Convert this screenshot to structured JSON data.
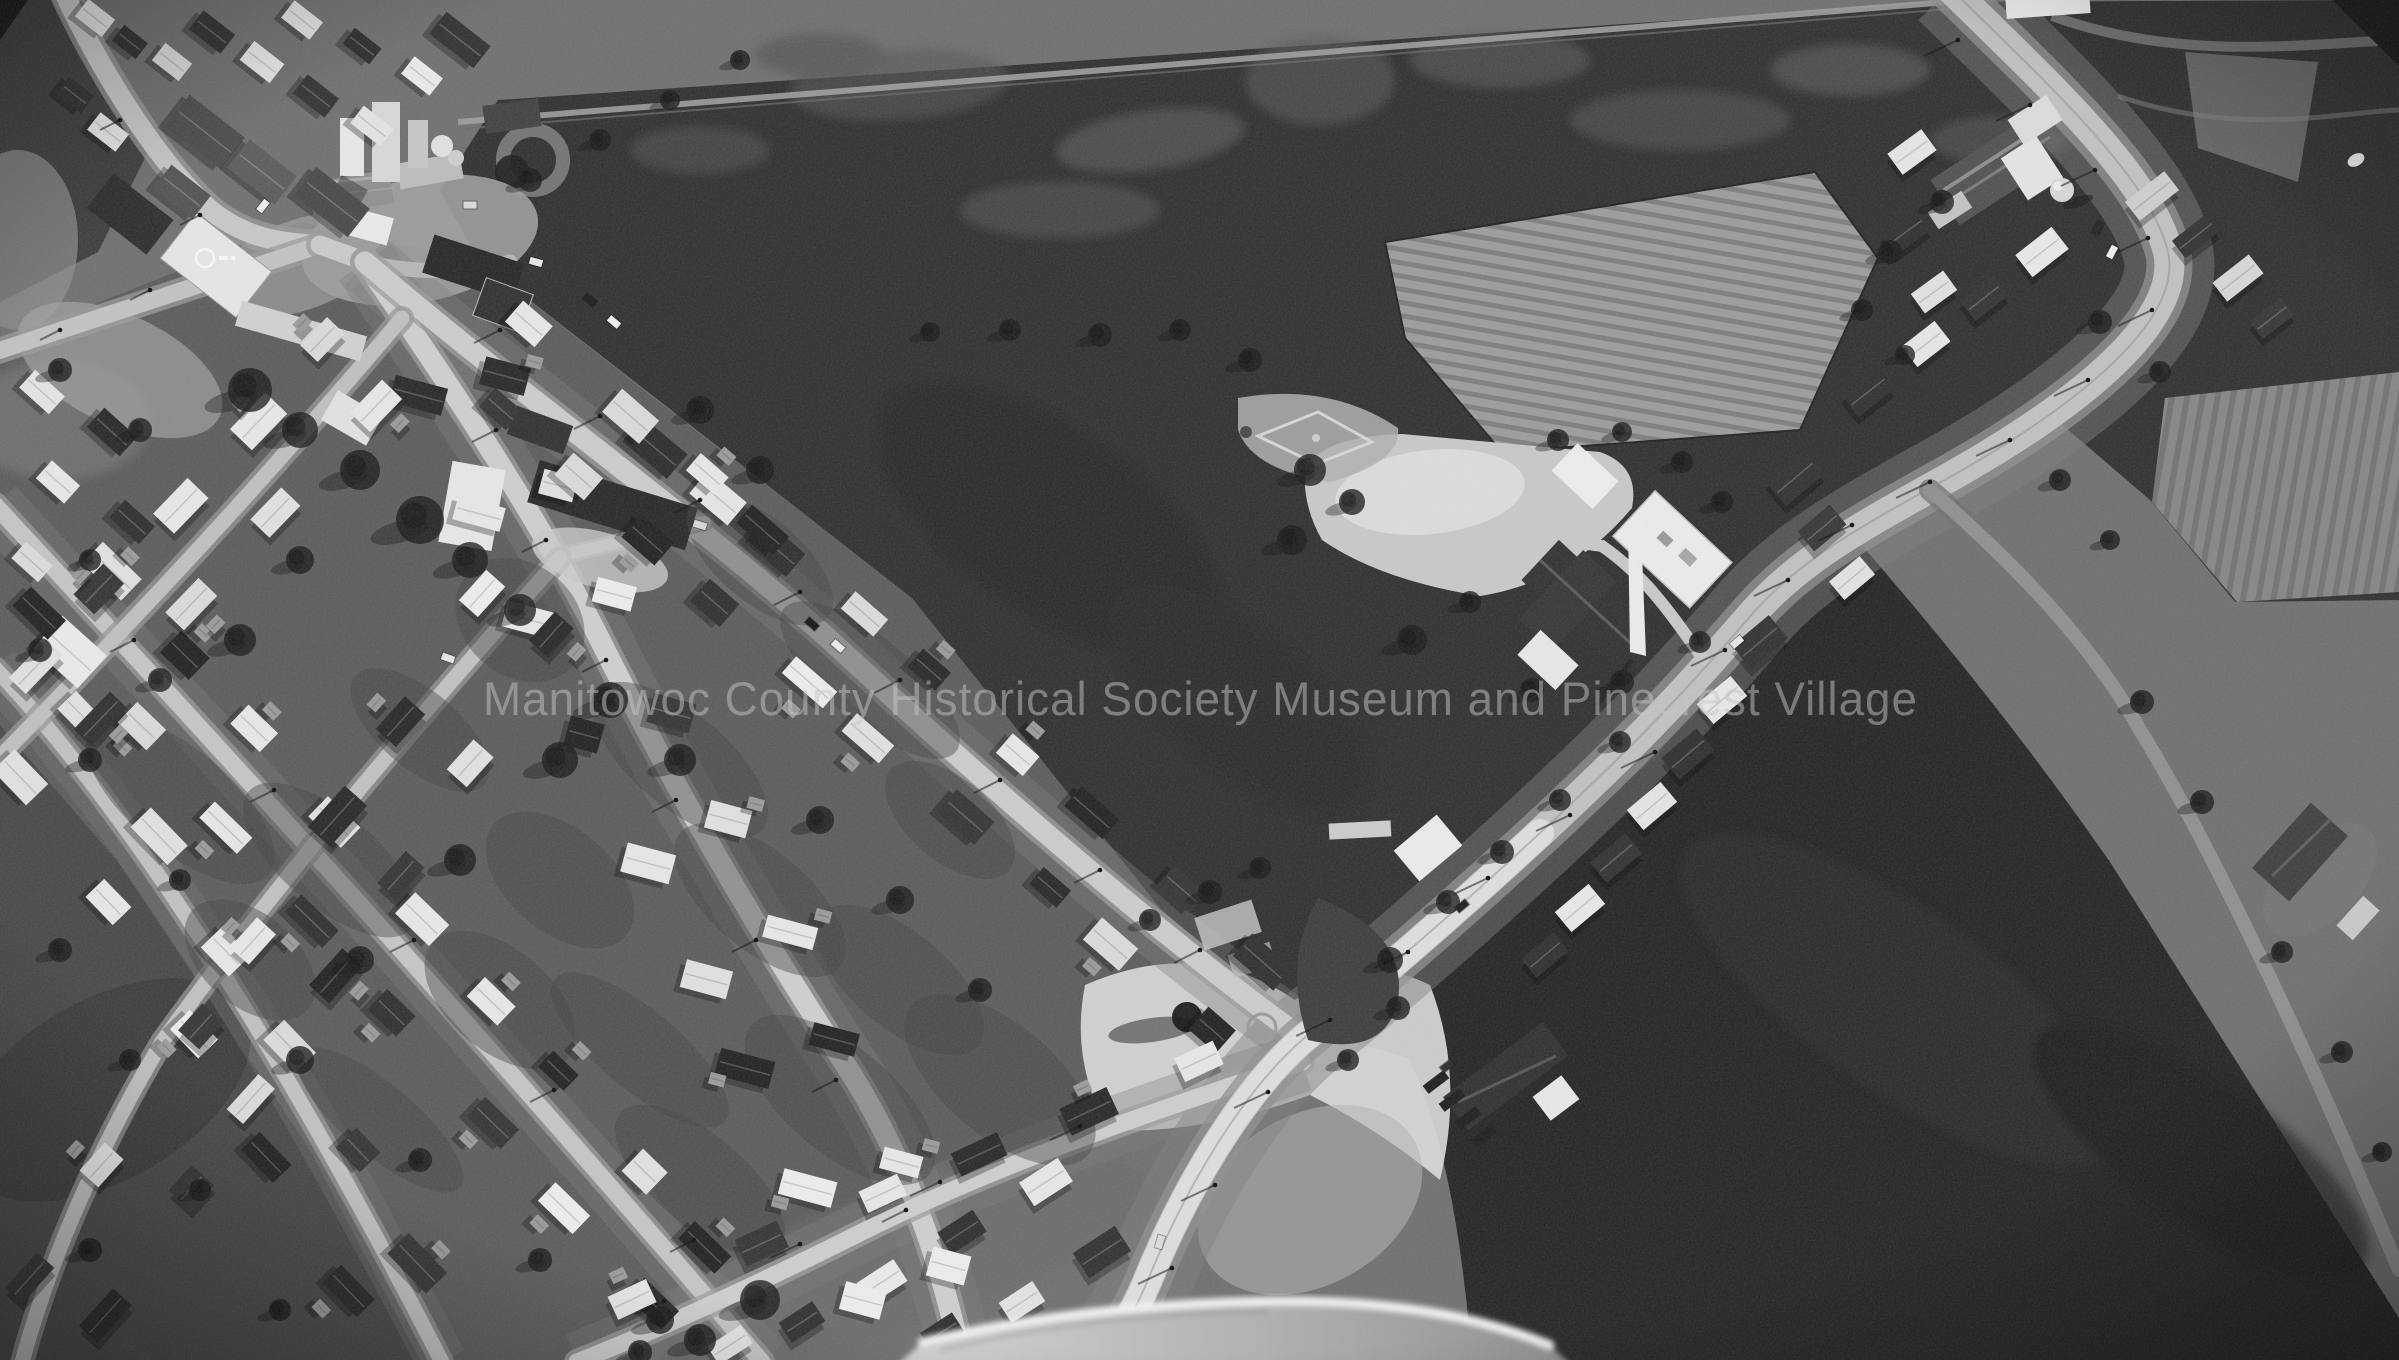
{
  "photo": {
    "description": "Black-and-white oblique aerial photograph of a small rural village: grain elevator at upper left, residential street grid at lower left, church, school and baseball diamond near center, a highway curving from the top right corner down to the bottom center, plowed and dark farm fields, and the photo plane's wing intruding at the bottom edge",
    "style": "monochrome"
  },
  "watermark": {
    "text": "Manitowoc County Historical Society Museum and Pinecrest Village",
    "color": "#c6c6c6"
  }
}
